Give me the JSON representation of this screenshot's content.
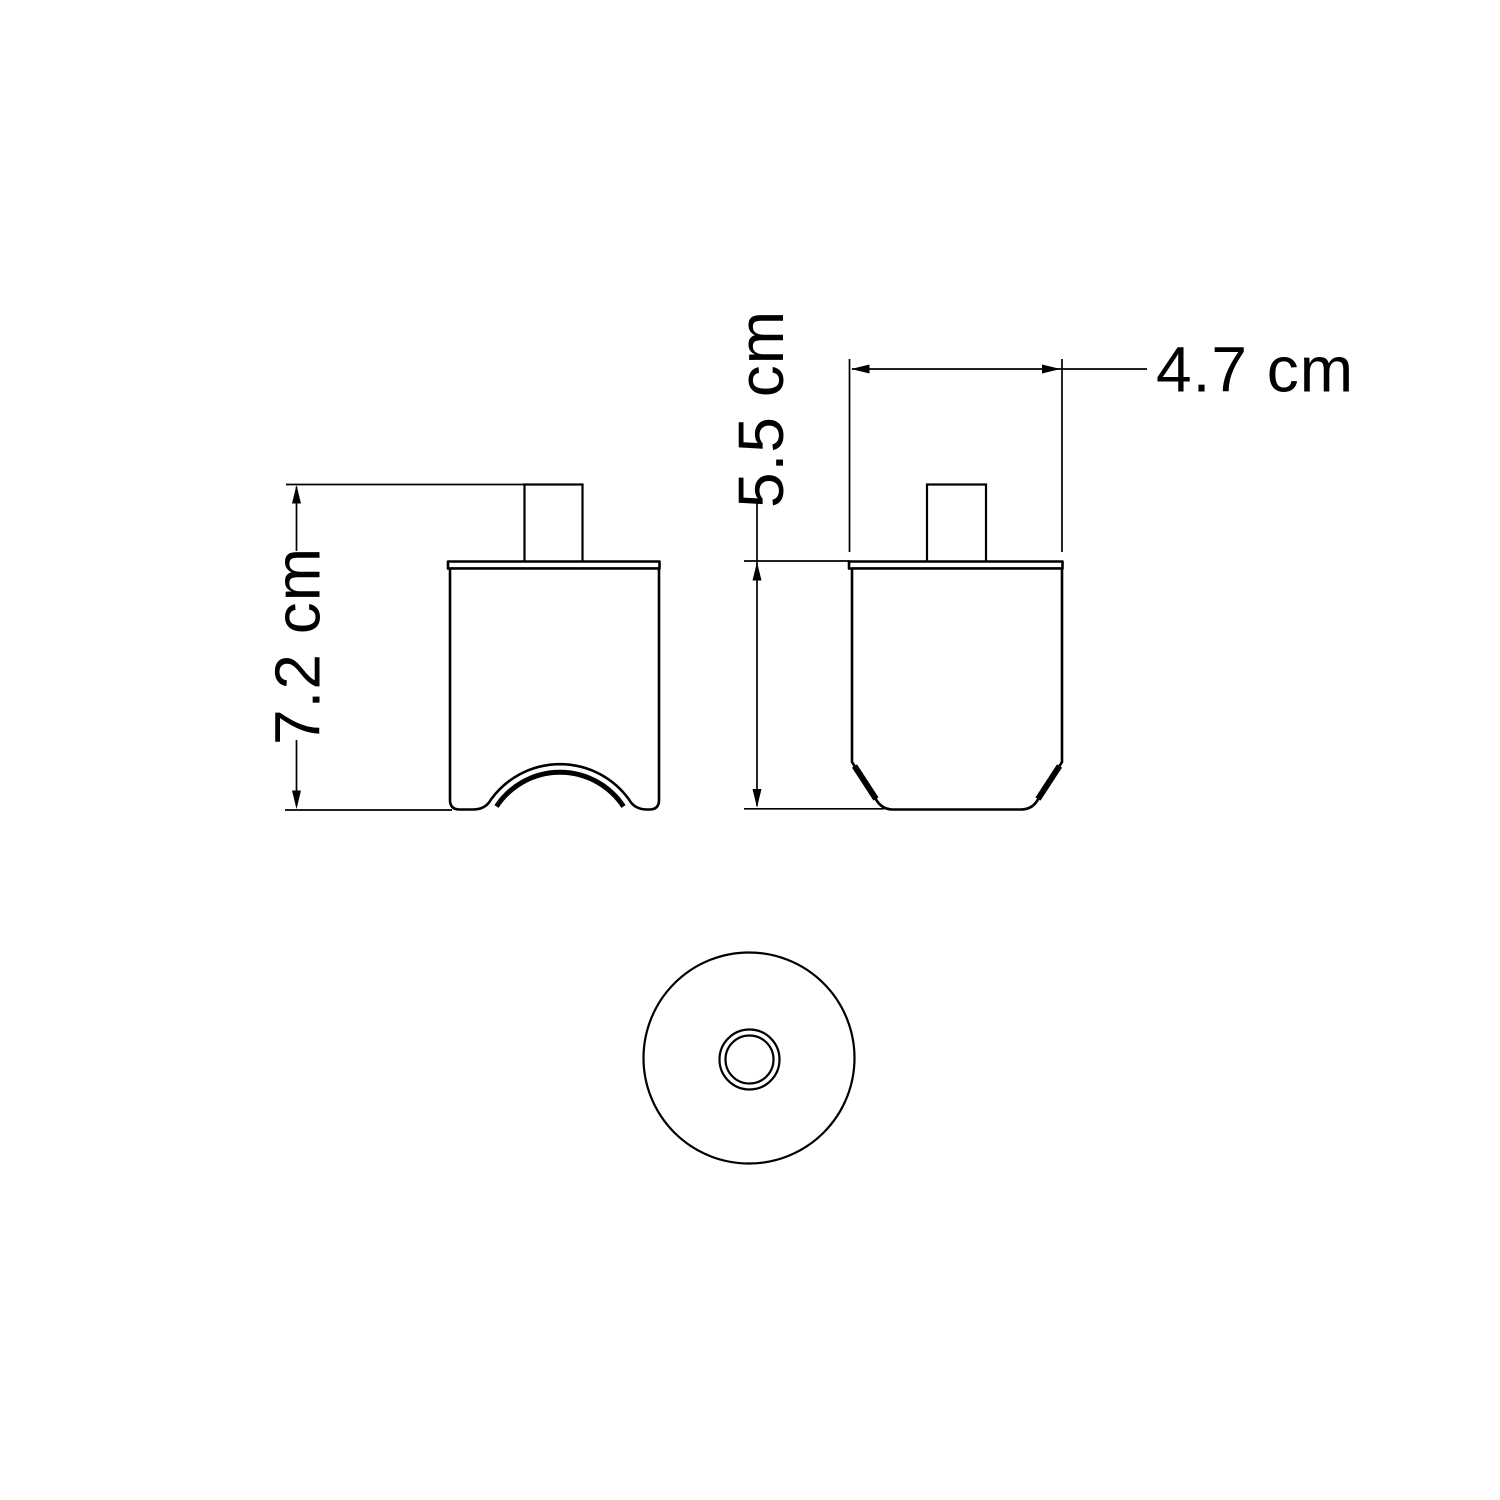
{
  "drawing": {
    "kind": "technical-dimension-drawing",
    "background_color": "#ffffff",
    "line_color": "#000000",
    "views": {
      "front": "front view with arched cable cutout",
      "side": "side view with chamfered base",
      "bottom": "bottom view with concentric center hole"
    },
    "dimensions": {
      "total_height": {
        "label": "7.2 cm",
        "value": 7.2,
        "unit": "cm"
      },
      "body_height": {
        "label": "5.5 cm",
        "value": 5.5,
        "unit": "cm"
      },
      "body_width": {
        "label": "4.7 cm",
        "value": 4.7,
        "unit": "cm"
      }
    }
  }
}
